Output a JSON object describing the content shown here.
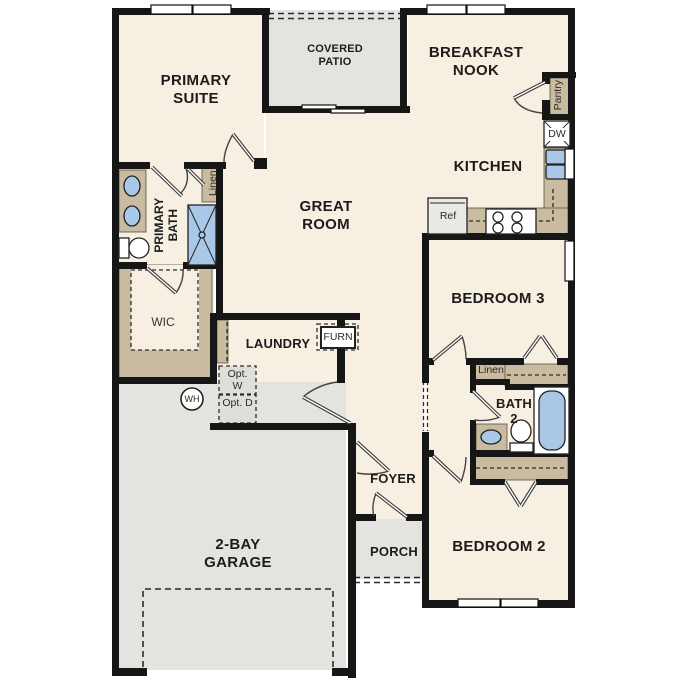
{
  "plan_title": "single-story floor plan",
  "colors": {
    "wall": "#161616",
    "floor_cream": "#f7f0e2",
    "exterior_gray": "#e4e3e0",
    "cabinet_tan": "#c9bb9f",
    "fixture_blue": "#a9c8e8",
    "appliance_gray": "#e9e9e6"
  },
  "rooms": {
    "primary_suite": {
      "label": "PRIMARY SUITE"
    },
    "covered_patio": {
      "label": "COVERED PATIO"
    },
    "breakfast_nook": {
      "label": "BREAKFAST NOOK"
    },
    "kitchen": {
      "label": "KITCHEN"
    },
    "great_room": {
      "label": "GREAT ROOM"
    },
    "primary_bath": {
      "label": "PRIMARY BATH"
    },
    "wic": {
      "label": "WIC"
    },
    "laundry": {
      "label": "LAUNDRY"
    },
    "bedroom3": {
      "label": "BEDROOM 3"
    },
    "bath2": {
      "label": "BATH 2"
    },
    "bedroom2": {
      "label": "BEDROOM 2"
    },
    "foyer": {
      "label": "FOYER"
    },
    "porch": {
      "label": "PORCH"
    },
    "garage": {
      "label": "2-BAY GARAGE"
    }
  },
  "closets": {
    "linen_primary": {
      "label": "Linen"
    },
    "linen_hall": {
      "label": "Linen"
    },
    "pantry": {
      "label": "Pantry"
    }
  },
  "equipment": {
    "dishwasher": {
      "label": "DW"
    },
    "refrigerator": {
      "label": "Ref"
    },
    "furnace": {
      "label": "FURN"
    },
    "water_heater": {
      "label": "WH"
    },
    "opt_washer": {
      "label": "Opt. W"
    },
    "opt_dryer": {
      "label": "Opt. D"
    }
  }
}
